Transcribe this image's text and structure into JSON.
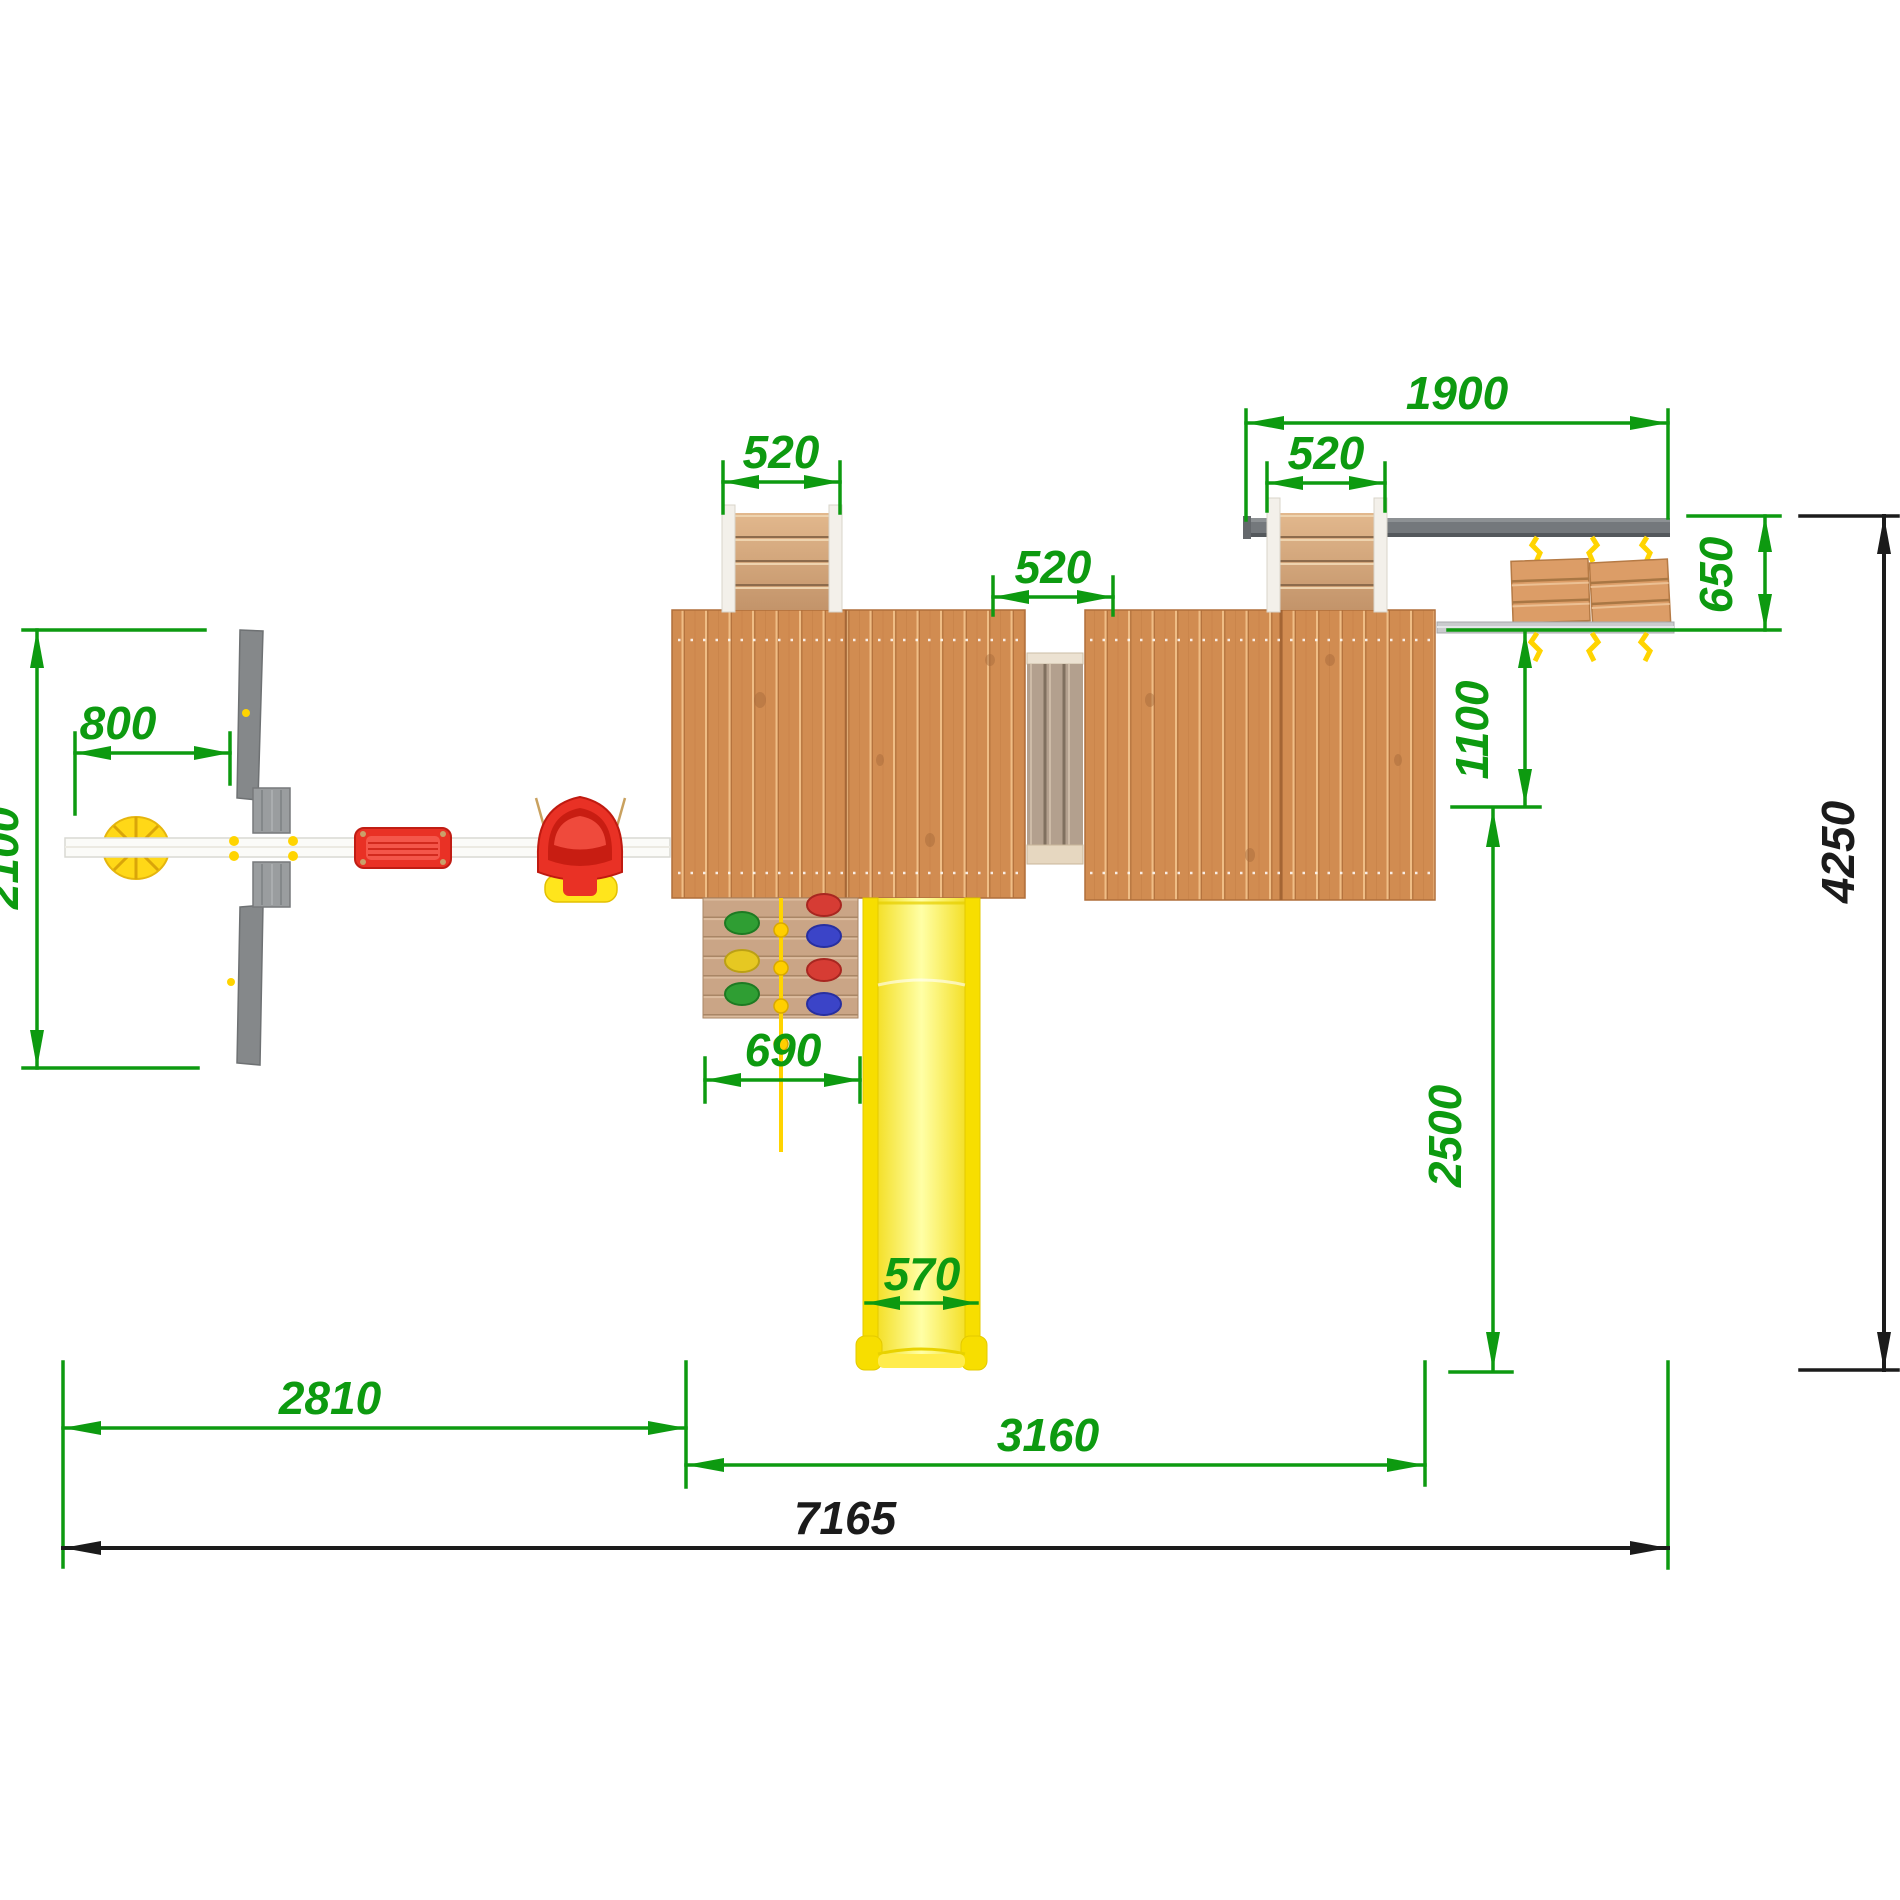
{
  "drawing": {
    "type": "playground-top-view-plan",
    "colors": {
      "dimension_green": "#0d9a10",
      "dimension_black": "#1b1b1b",
      "platform_wood": "#d18c51",
      "ladder_wood": "#cba27c",
      "climb_wall_wood": "#caa586",
      "bridge_wood": "#b3a08e",
      "swing_beam_gray": "#74787c",
      "frame_rail_gray": "#c9cbcd",
      "white_beam": "#fbfbf8",
      "a_frame_gray": "#85888a",
      "slide_yellow": "#f7de00",
      "rope_yellow": "#ffd400",
      "seat_red": "#e93125",
      "disc_yellow": "#ffd817",
      "hold_green": "#2f9e33",
      "hold_red": "#d63c34",
      "hold_blue": "#3b44c8",
      "hold_yellow": "#e6c822"
    },
    "dims": {
      "total_width": "7165",
      "total_depth": "4250",
      "left_section": "2810",
      "platform_section": "3160",
      "swing_beam_length": "1900",
      "stair_left": "520",
      "bridge_width": "520",
      "stair_right": "520",
      "beam_to_rail": "650",
      "rail_to_platform": "1100",
      "safety_zone": "2500",
      "frame_depth": "2100",
      "beam_overhang": "800",
      "climbing_wall": "690",
      "slide_width": "570"
    }
  }
}
